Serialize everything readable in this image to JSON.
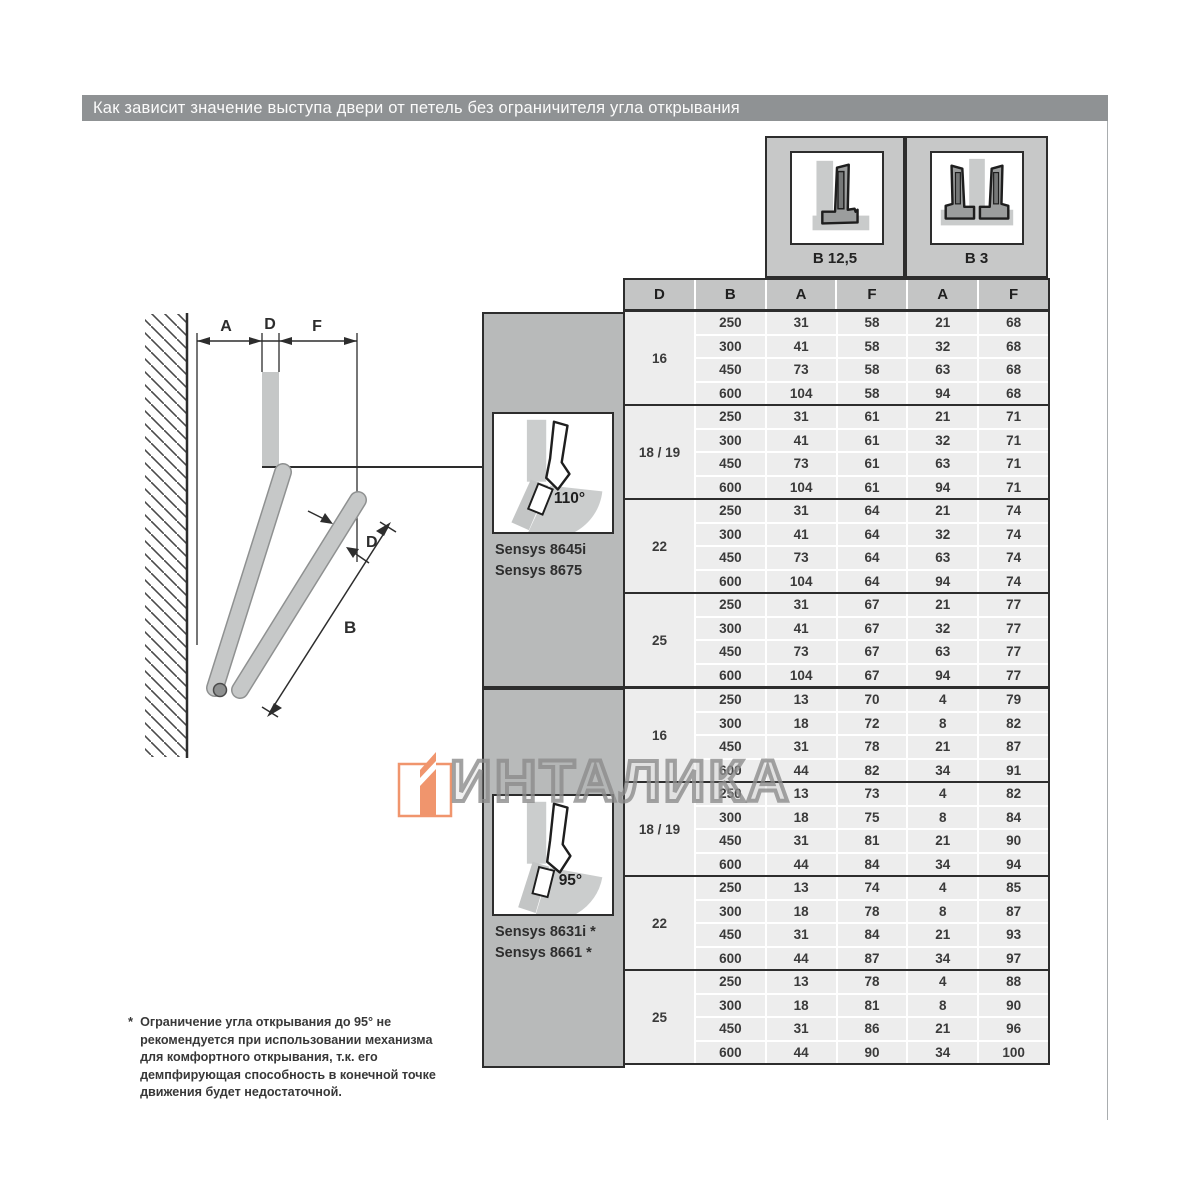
{
  "title": "Как зависит значение выступа двери от петель без ограничителя угла открывания",
  "watermark": {
    "text": "ИНТАЛИКА"
  },
  "mount_types": [
    {
      "label": "B 12,5",
      "icon": "hinge-overlay-icon"
    },
    {
      "label": "B 3",
      "icon": "hinge-twin-icon"
    }
  ],
  "table": {
    "columns": [
      "D",
      "B",
      "A",
      "F",
      "A",
      "F"
    ],
    "sections": [
      {
        "angle": "110°",
        "models": [
          "Sensys 8645i",
          "Sensys 8675"
        ],
        "groups": [
          {
            "d": "16",
            "rows": [
              [
                "250",
                "31",
                "58",
                "21",
                "68"
              ],
              [
                "300",
                "41",
                "58",
                "32",
                "68"
              ],
              [
                "450",
                "73",
                "58",
                "63",
                "68"
              ],
              [
                "600",
                "104",
                "58",
                "94",
                "68"
              ]
            ]
          },
          {
            "d": "18 / 19",
            "rows": [
              [
                "250",
                "31",
                "61",
                "21",
                "71"
              ],
              [
                "300",
                "41",
                "61",
                "32",
                "71"
              ],
              [
                "450",
                "73",
                "61",
                "63",
                "71"
              ],
              [
                "600",
                "104",
                "61",
                "94",
                "71"
              ]
            ]
          },
          {
            "d": "22",
            "rows": [
              [
                "250",
                "31",
                "64",
                "21",
                "74"
              ],
              [
                "300",
                "41",
                "64",
                "32",
                "74"
              ],
              [
                "450",
                "73",
                "64",
                "63",
                "74"
              ],
              [
                "600",
                "104",
                "64",
                "94",
                "74"
              ]
            ]
          },
          {
            "d": "25",
            "rows": [
              [
                "250",
                "31",
                "67",
                "21",
                "77"
              ],
              [
                "300",
                "41",
                "67",
                "32",
                "77"
              ],
              [
                "450",
                "73",
                "67",
                "63",
                "77"
              ],
              [
                "600",
                "104",
                "67",
                "94",
                "77"
              ]
            ]
          }
        ]
      },
      {
        "angle": "95°",
        "models": [
          "Sensys 8631i *",
          "Sensys 8661 *"
        ],
        "groups": [
          {
            "d": "16",
            "rows": [
              [
                "250",
                "13",
                "70",
                "4",
                "79"
              ],
              [
                "300",
                "18",
                "72",
                "8",
                "82"
              ],
              [
                "450",
                "31",
                "78",
                "21",
                "87"
              ],
              [
                "600",
                "44",
                "82",
                "34",
                "91"
              ]
            ]
          },
          {
            "d": "18 / 19",
            "rows": [
              [
                "250",
                "13",
                "73",
                "4",
                "82"
              ],
              [
                "300",
                "18",
                "75",
                "8",
                "84"
              ],
              [
                "450",
                "31",
                "81",
                "21",
                "90"
              ],
              [
                "600",
                "44",
                "84",
                "34",
                "94"
              ]
            ]
          },
          {
            "d": "22",
            "rows": [
              [
                "250",
                "13",
                "74",
                "4",
                "85"
              ],
              [
                "300",
                "18",
                "78",
                "8",
                "87"
              ],
              [
                "450",
                "31",
                "84",
                "21",
                "93"
              ],
              [
                "600",
                "44",
                "87",
                "34",
                "97"
              ]
            ]
          },
          {
            "d": "25",
            "rows": [
              [
                "250",
                "13",
                "78",
                "4",
                "88"
              ],
              [
                "300",
                "18",
                "81",
                "8",
                "90"
              ],
              [
                "450",
                "31",
                "86",
                "21",
                "96"
              ],
              [
                "600",
                "44",
                "90",
                "34",
                "100"
              ]
            ]
          }
        ]
      }
    ]
  },
  "diagram": {
    "labels": {
      "a": "A",
      "d_top": "D",
      "f": "F",
      "d_side": "D",
      "b": "B"
    }
  },
  "footnote": {
    "marker": "*",
    "text": "Ограничение угла открывания до 95° не\nрекомендуется при использовании механизма\nдля комфортного открывания, т.к. его\nдемпфирующая способность в конечной точке\nдвижения будет недостаточной."
  },
  "colors": {
    "title_bar": "#8f9294",
    "header_bg": "#c4c5c5",
    "panel_bg": "#b8baba",
    "cell_bg": "#ededed",
    "line_dark": "#2d2d2d",
    "watermark_gray": "#969696",
    "logo_orange": "#ef8a5e"
  }
}
